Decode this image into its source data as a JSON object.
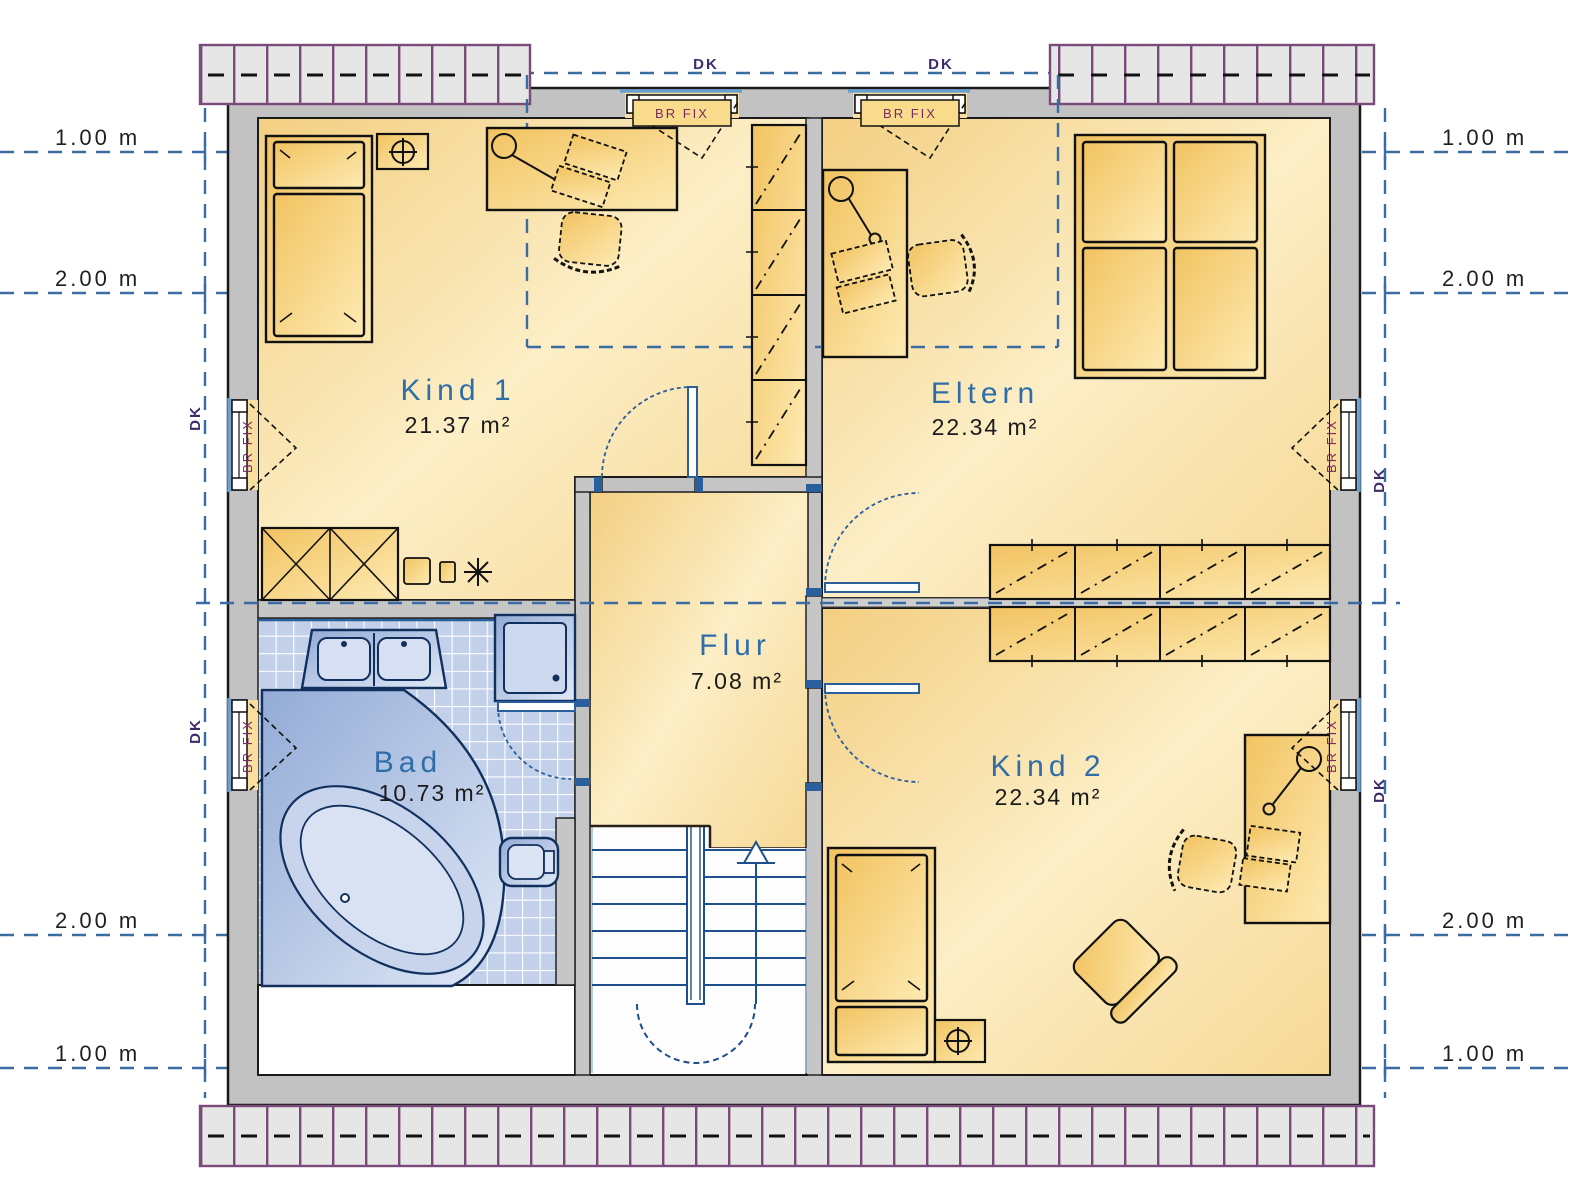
{
  "rooms": {
    "kind1": {
      "name": "Kind 1",
      "area": "21.37 m²"
    },
    "eltern": {
      "name": "Eltern",
      "area": "22.34 m²"
    },
    "flur": {
      "name": "Flur",
      "area": "7.08 m²"
    },
    "bad": {
      "name": "Bad",
      "area": "10.73 m²"
    },
    "kind2": {
      "name": "Kind 2",
      "area": "22.34 m²"
    }
  },
  "dimension_labels": {
    "left": [
      "1.00 m",
      "2.00 m",
      "2.00 m",
      "1.00 m"
    ],
    "right": [
      "1.00 m",
      "2.00 m",
      "2.00 m",
      "1.00 m"
    ]
  },
  "window_labels": {
    "dk": "DK",
    "br_fix": "BR FIX"
  },
  "colors": {
    "wall_fill": "#c2c2c2",
    "outline": "#1a1a1a",
    "room_fill": "#f4d084",
    "room_light": "#fceec8",
    "furniture_fill": "#f3c765",
    "bath_tile": "#c2d0e9",
    "fixture_fill": "#9fb6de",
    "fixture_outline": "#12305e",
    "dimension_dash_blue": "#3a6ca3",
    "door_blue": "#2a5f9e",
    "stair_blue": "#1f4e8c",
    "roof_band_fill": "#e6e6e6",
    "roof_band_border": "#7a4a7a",
    "room_label_blue": "#2e6da8",
    "br_fix_purple": "#7c2a62",
    "dk_purple": "#3d2b6b"
  }
}
